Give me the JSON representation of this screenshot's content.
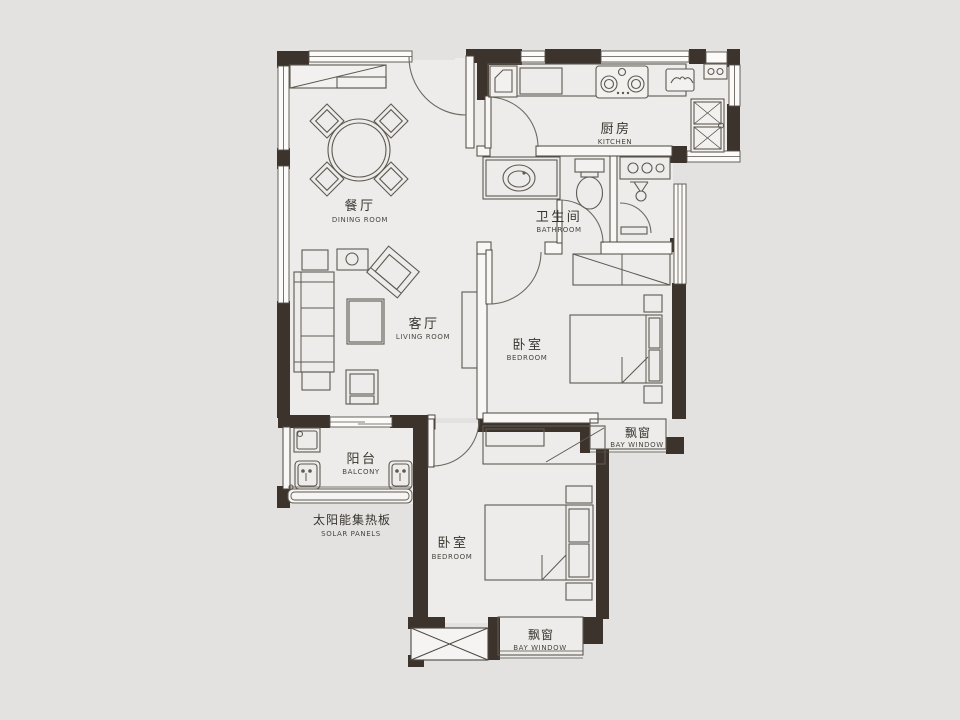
{
  "floorplan": {
    "rooms": {
      "dining": {
        "zh": "餐厅",
        "en": "DINING ROOM"
      },
      "kitchen": {
        "zh": "厨房",
        "en": "KITCHEN"
      },
      "bathroom": {
        "zh": "卫生间",
        "en": "BATHROOM"
      },
      "living": {
        "zh": "客厅",
        "en": "LIVING ROOM"
      },
      "bedroom1": {
        "zh": "卧室",
        "en": "BEDROOM"
      },
      "bedroom2": {
        "zh": "卧室",
        "en": "BEDROOM"
      },
      "balcony": {
        "zh": "阳台",
        "en": "BALCONY"
      },
      "bay_window_east": {
        "zh": "飘窗",
        "en": "BAY WINDOW"
      },
      "bay_window_south": {
        "zh": "飘窗",
        "en": "BAY WINDOW"
      },
      "solar": {
        "zh": "太阳能集热板",
        "en": "SOLAR PANELS"
      }
    },
    "colors": {
      "wall": "#3b332c",
      "floor": "#edecea",
      "background": "#e3e2e1",
      "line": "#5f5952",
      "text_primary": "#3a342e",
      "text_secondary": "#4b453f"
    }
  }
}
